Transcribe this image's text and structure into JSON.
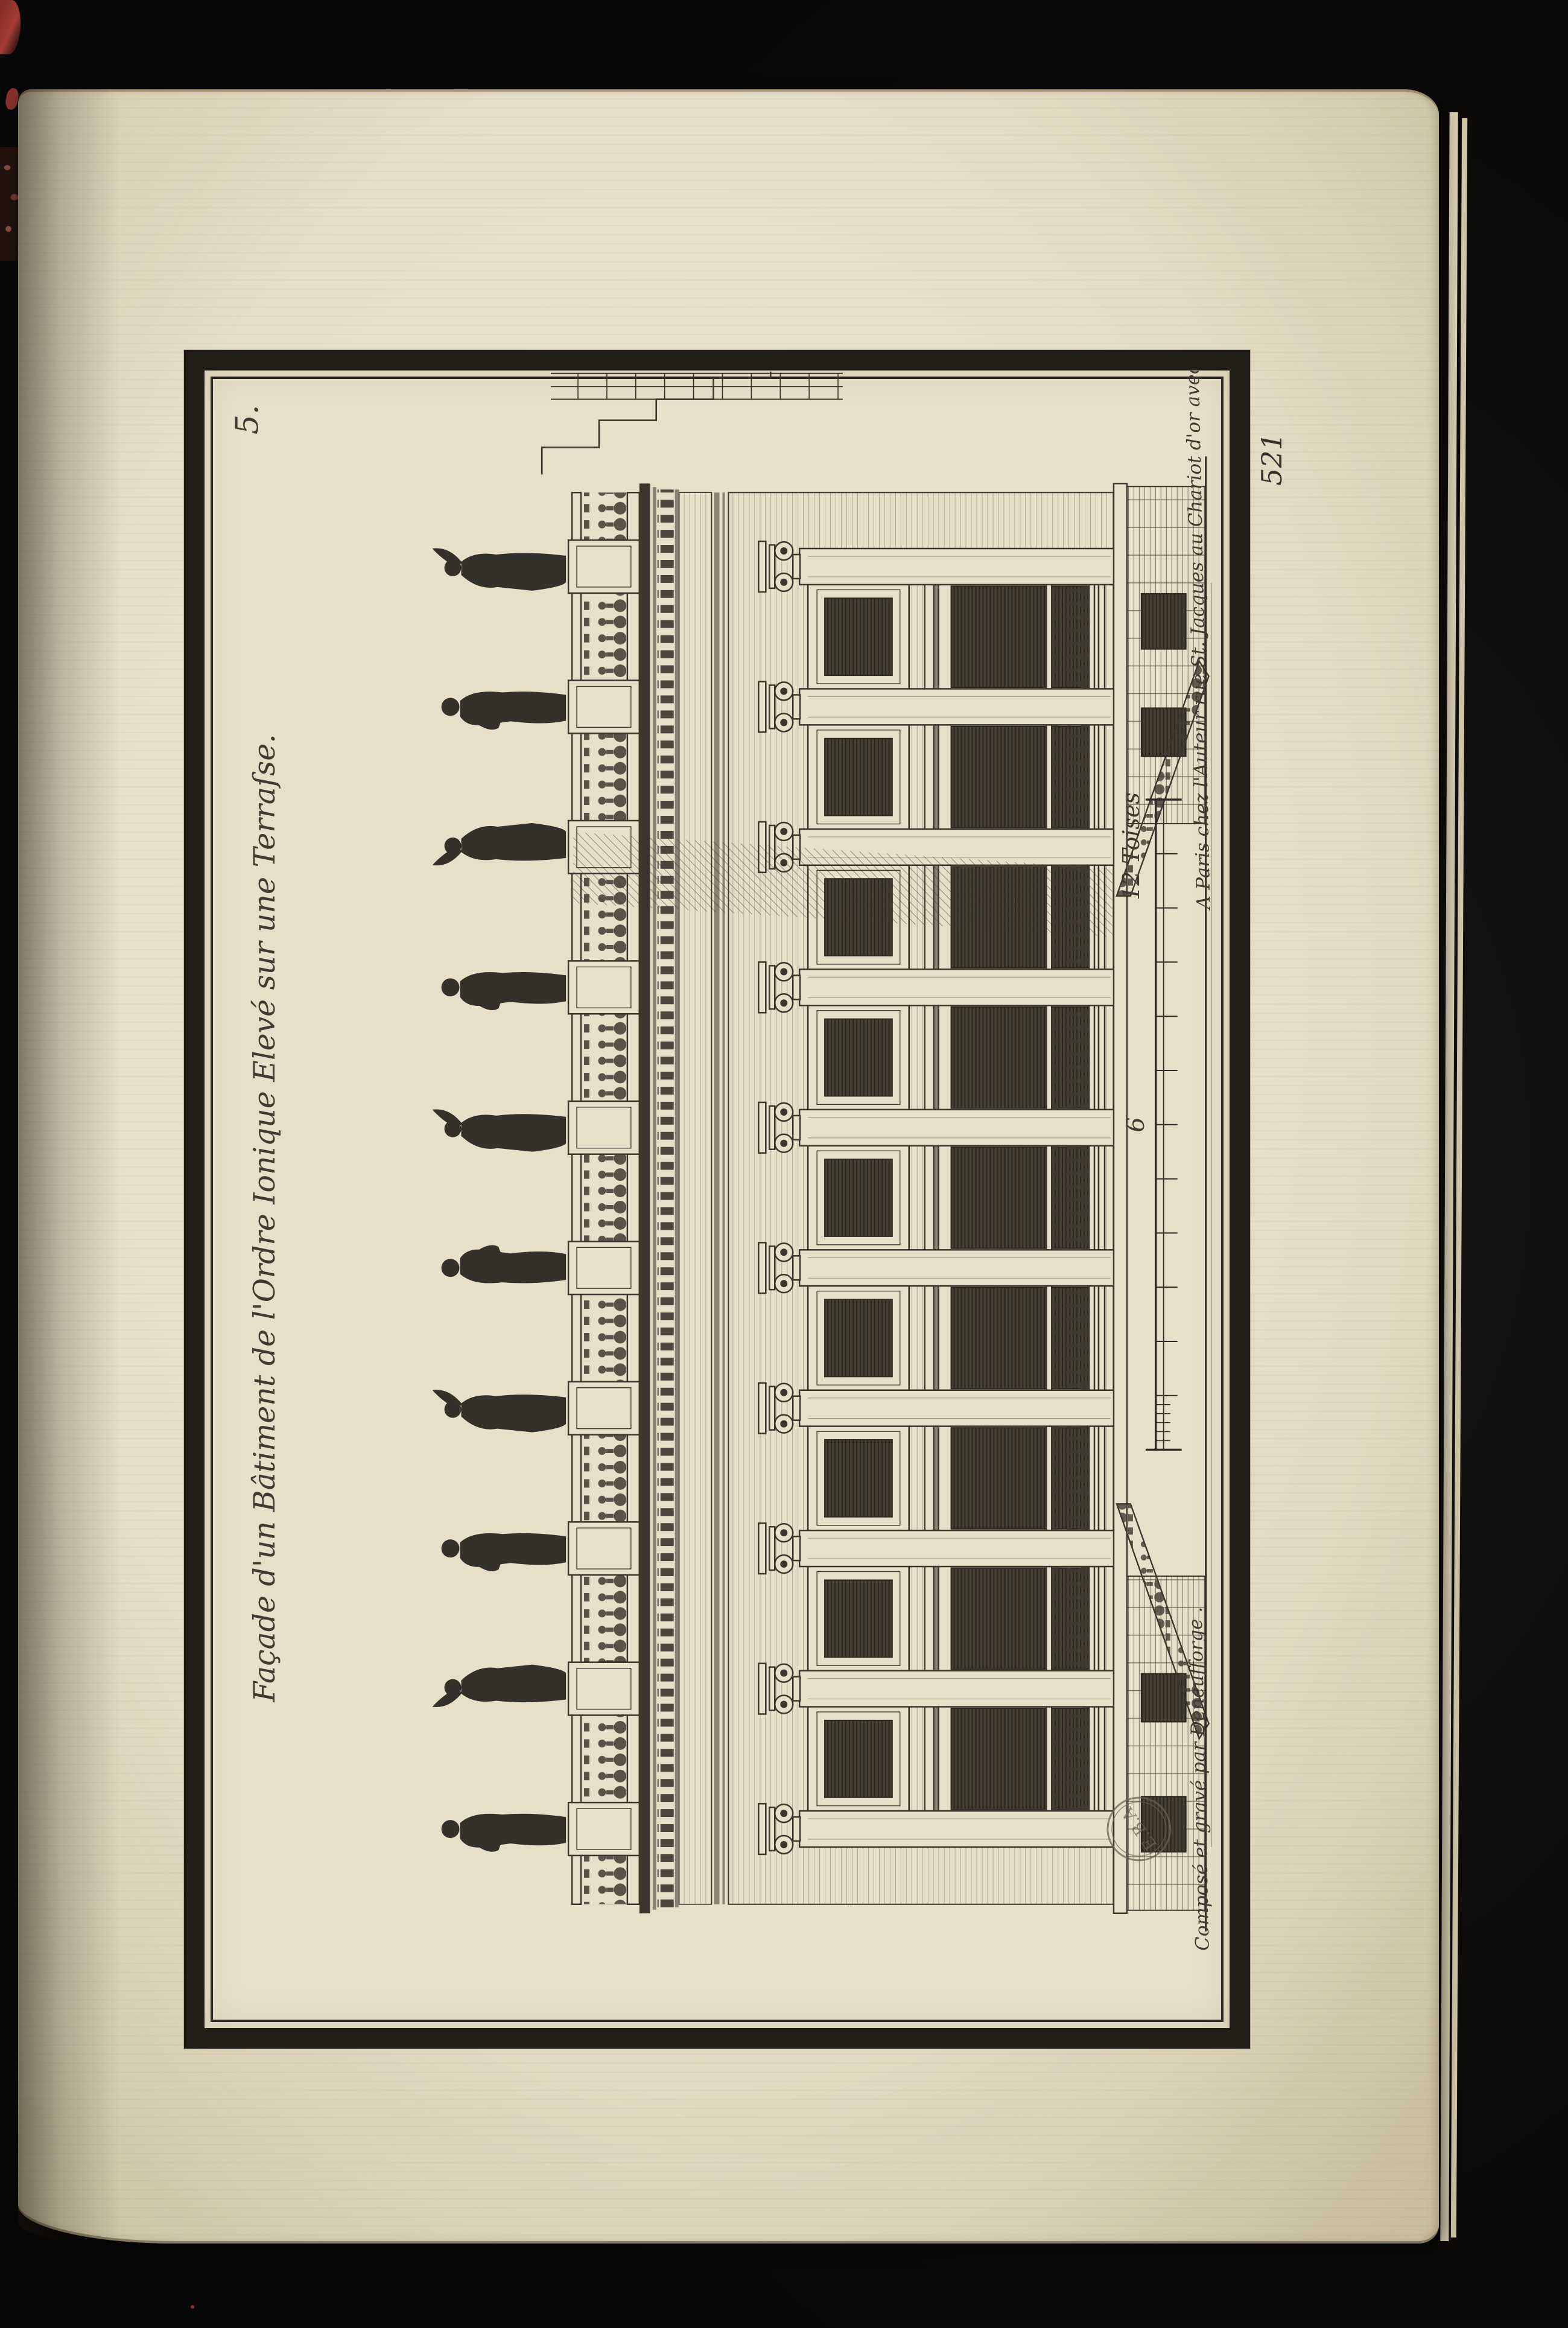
{
  "document": {
    "kind": "Engraved architectural plate bound in a book, printed rotated 90° on the page"
  },
  "plate": {
    "number": "5.",
    "title": "Façade d'un Bâtiment de l'Ordre Ionique Elevé sur une Terraſse.",
    "credit_left": "Composé et gravé par Deneufforge .",
    "credit_right": "A Paris chez l'Auteur rue St. Jacques au Chariot d'or avec Privilege du Roy .",
    "stamp_text": "E.B.A",
    "scale": {
      "mid_label": "6",
      "end_label": "12 Toises",
      "divisions": 12
    }
  },
  "page": {
    "number": "521"
  },
  "engraving": {
    "subject": "Elevation of an Ionic-order building raised on a terrace: statues over a balustrade, entablature with dentils, attic and tall glazed windows between Ionic pilasters, balustraded balconies, flanking terrace ramps and a toise scale",
    "statue_count": 10,
    "bay_count": 9
  },
  "colors": {
    "paper": "#e7e0c9",
    "ink": "#3a362c",
    "frame": "#211e18",
    "background": "#0c0b0a",
    "red_mark": "#a03a32"
  }
}
